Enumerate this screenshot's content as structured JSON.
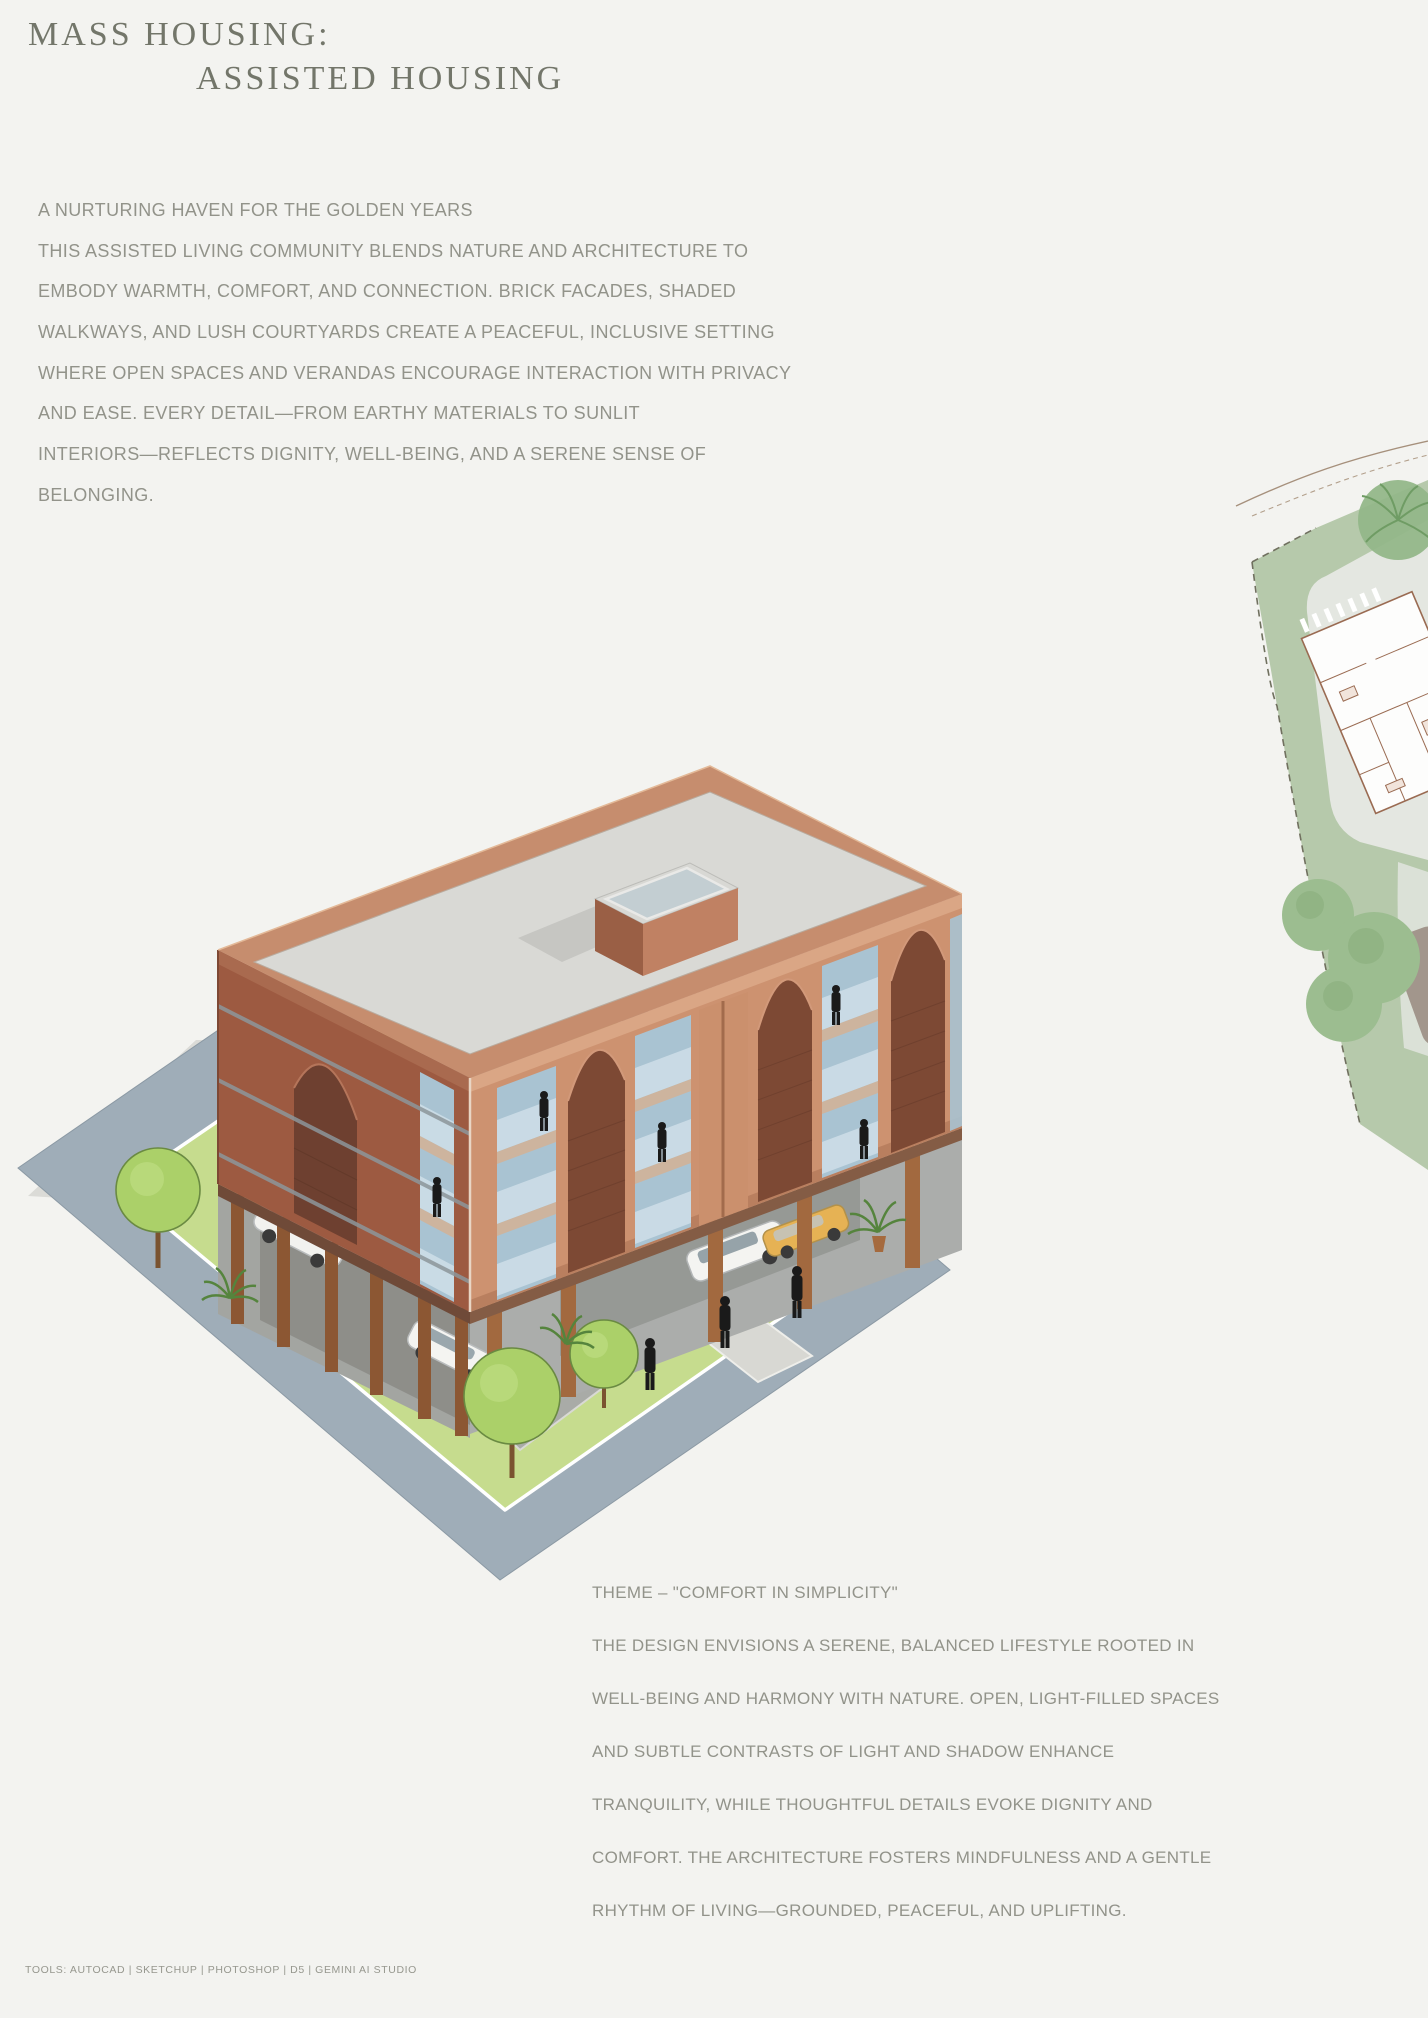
{
  "header": {
    "title_line1": "MASS HOUSING:",
    "title_line2": "ASSISTED HOUSING"
  },
  "intro": {
    "lines": [
      "A NURTURING HAVEN FOR THE GOLDEN YEARS",
      "THIS ASSISTED LIVING COMMUNITY BLENDS NATURE AND ARCHITECTURE TO",
      "EMBODY WARMTH, COMFORT, AND CONNECTION. BRICK FACADES, SHADED",
      "WALKWAYS, AND LUSH COURTYARDS CREATE A PEACEFUL, INCLUSIVE SETTING",
      "WHERE OPEN SPACES AND VERANDAS ENCOURAGE INTERACTION WITH PRIVACY",
      "AND EASE. EVERY DETAIL—FROM EARTHY MATERIALS TO SUNLIT",
      "INTERIORS—REFLECTS DIGNITY, WELL-BEING, AND A SERENE SENSE OF",
      "BELONGING."
    ]
  },
  "theme": {
    "lines": [
      "THEME – \"COMFORT IN SIMPLICITY\"",
      "THE DESIGN ENVISIONS A SERENE, BALANCED LIFESTYLE ROOTED IN",
      "WELL-BEING AND HARMONY WITH NATURE. OPEN, LIGHT-FILLED SPACES",
      "AND SUBTLE CONTRASTS OF LIGHT AND SHADOW ENHANCE",
      "TRANQUILITY, WHILE THOUGHTFUL DETAILS EVOKE DIGNITY AND",
      "COMFORT. THE ARCHITECTURE FOSTERS MINDFULNESS AND A GENTLE",
      "RHYTHM OF LIVING—GROUNDED, PEACEFUL, AND UPLIFTING."
    ]
  },
  "footer": {
    "tools_label": "TOOLS: AUTOCAD | SKETCHUP | PHOTOSHOP | D5 | GEMINI AI STUDIO"
  },
  "illustrations": {
    "main": "axonometric-brick-apartment-building-rendering",
    "side": "site-plan-fragment"
  },
  "palette": {
    "page_bg": "#f3f3f0",
    "body_text": "#92938a",
    "title_text": "#73766a",
    "brick_light": "#cd9270",
    "brick_dark": "#9d5a41",
    "arch_brick": "#7c4733",
    "roof": "#d9d9d5",
    "glass": "#a9c3d2",
    "railing": "#cfdfe9",
    "road": "#9fadb8",
    "lawn": "#c6dc8e",
    "column": "#9a6440",
    "cast_shadow": "#dbdbd7",
    "figure": "#1c1c1c",
    "tree": "#abd069",
    "taxi_yellow": "#e6b254",
    "site_green": "#b6c9ab",
    "site_paper": "#e4e7e1",
    "plan_line": "#9a6b52"
  }
}
